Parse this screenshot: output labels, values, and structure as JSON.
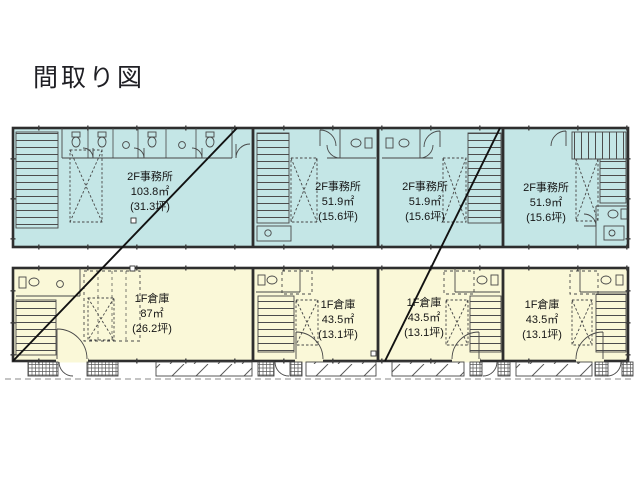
{
  "title": "間取り図",
  "colors": {
    "office_fill": "#c4e6e6",
    "warehouse_fill": "#faf8d8",
    "wall": "#2e2e2e",
    "link_line": "#111111"
  },
  "floor2_units": [
    {
      "name": "2F事務所",
      "area": "103.8㎡",
      "tsubo": "(31.3坪)"
    },
    {
      "name": "2F事務所",
      "area": "51.9㎡",
      "tsubo": "(15.6坪)"
    },
    {
      "name": "2F事務所",
      "area": "51.9㎡",
      "tsubo": "(15.6坪)"
    },
    {
      "name": "2F事務所",
      "area": "51.9㎡",
      "tsubo": "(15.6坪)"
    }
  ],
  "floor1_units": [
    {
      "name": "1F倉庫",
      "area": "87㎡",
      "tsubo": "(26.2坪)"
    },
    {
      "name": "1F倉庫",
      "area": "43.5㎡",
      "tsubo": "(13.1坪)"
    },
    {
      "name": "1F倉庫",
      "area": "43.5㎡",
      "tsubo": "(13.1坪)"
    },
    {
      "name": "1F倉庫",
      "area": "43.5㎡",
      "tsubo": "(13.1坪)"
    }
  ]
}
